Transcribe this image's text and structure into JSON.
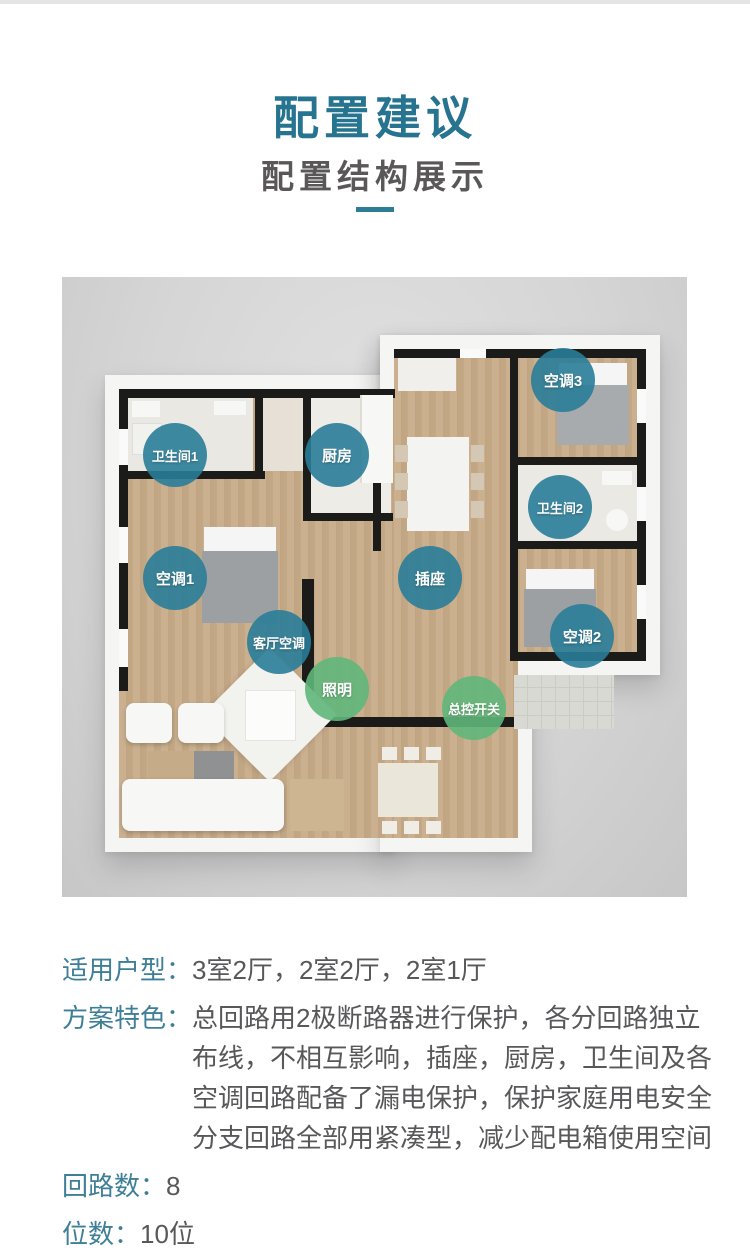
{
  "theme": {
    "title_color": "#26748f",
    "subtitle_color": "#595757",
    "divider_color": "#2e7d97",
    "label_color": "#3e7f97",
    "text_color": "#58585a",
    "badge_teal": "rgba(41,125,152,0.9)",
    "badge_green": "rgba(97,183,122,0.9)"
  },
  "header": {
    "title": "配置建议",
    "subtitle": "配置结构展示"
  },
  "floorplan": {
    "description": "三居室户型俯视渲染图，标注配电回路位置",
    "badges": [
      {
        "id": "bathroom1",
        "label": "卫生间1",
        "type": "teal",
        "x": 113,
        "y": 178
      },
      {
        "id": "kitchen",
        "label": "厨房",
        "type": "teal",
        "x": 275,
        "y": 178
      },
      {
        "id": "ac3",
        "label": "空调3",
        "type": "teal",
        "x": 501,
        "y": 103
      },
      {
        "id": "bathroom2",
        "label": "卫生间2",
        "type": "teal",
        "x": 498,
        "y": 230
      },
      {
        "id": "ac1",
        "label": "空调1",
        "type": "teal",
        "x": 113,
        "y": 301
      },
      {
        "id": "socket",
        "label": "插座",
        "type": "teal",
        "x": 368,
        "y": 301
      },
      {
        "id": "ac2",
        "label": "空调2",
        "type": "teal",
        "x": 520,
        "y": 359
      },
      {
        "id": "living-ac",
        "label": "客厅空调",
        "type": "teal",
        "x": 217,
        "y": 365
      },
      {
        "id": "lighting",
        "label": "照明",
        "type": "green",
        "x": 275,
        "y": 412
      },
      {
        "id": "master-switch",
        "label": "总控开关",
        "type": "green",
        "x": 412,
        "y": 431
      }
    ]
  },
  "specs": {
    "separator": "：",
    "rows": [
      {
        "label": "适用户型",
        "lines": [
          "3室2厅，2室2厅，2室1厅"
        ]
      },
      {
        "label": "方案特色",
        "lines": [
          "总回路用2极断路器进行保护，各分回路独立",
          "布线，不相互影响，插座，厨房，卫生间及各",
          "空调回路配备了漏电保护，保护家庭用电安全",
          "分支回路全部用紧凑型，减少配电箱使用空间"
        ]
      },
      {
        "label": "回路数",
        "lines": [
          "8"
        ]
      },
      {
        "label": "位数",
        "lines": [
          "10位"
        ]
      }
    ]
  }
}
